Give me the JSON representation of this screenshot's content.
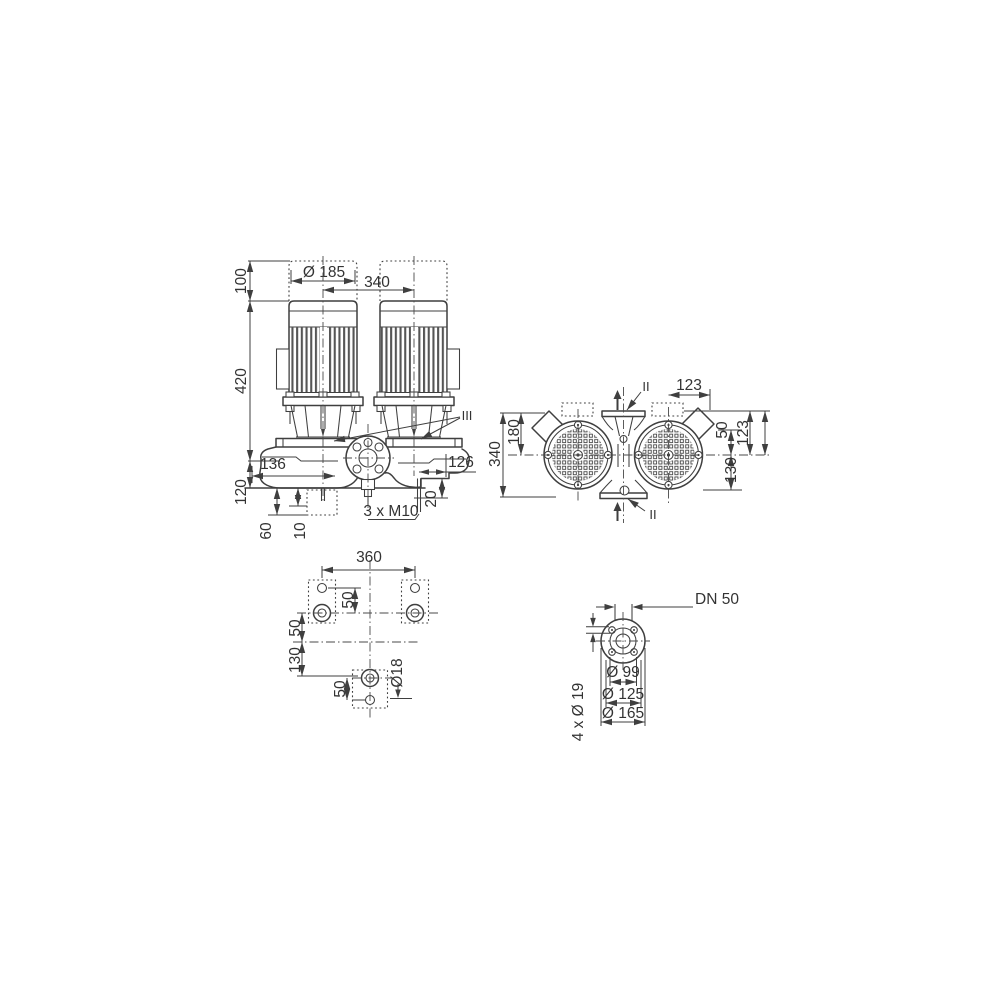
{
  "colors": {
    "line": "#3f3f3f",
    "text": "#333333",
    "background": "#ffffff"
  },
  "front_view": {
    "section_label": "III",
    "dims": {
      "top_clearance": "100",
      "motor_height": "420",
      "base_height": "120",
      "motor_diameter": "Ø 185",
      "motor_spacing": "340",
      "left_to_center": "136",
      "center_to_right": "126",
      "stud_length": "20",
      "stud_thread": "3 x M10",
      "foot_depth": "60",
      "pad_depth": "10"
    }
  },
  "top_view": {
    "section_label": "II",
    "dims": {
      "overall_depth": "340",
      "rear_to_center": "180",
      "center_to_edge_top": "123",
      "box_offset": "50",
      "box_to_center": "123",
      "center_to_front": "130"
    }
  },
  "foot_plan": {
    "dims": {
      "bolt_spacing": "360",
      "upper_hole_offset": "50",
      "center_offset": "50",
      "lower_offset": "130",
      "lower_hole_offset": "50",
      "hole_diameter": "Ø18"
    }
  },
  "flange_view": {
    "dims": {
      "nominal_diameter": "DN 50",
      "inner_diameter": "Ø 99",
      "bolt_circle": "Ø 125",
      "outer_diameter": "Ø 165",
      "bolt_holes": "4 x Ø 19"
    }
  }
}
